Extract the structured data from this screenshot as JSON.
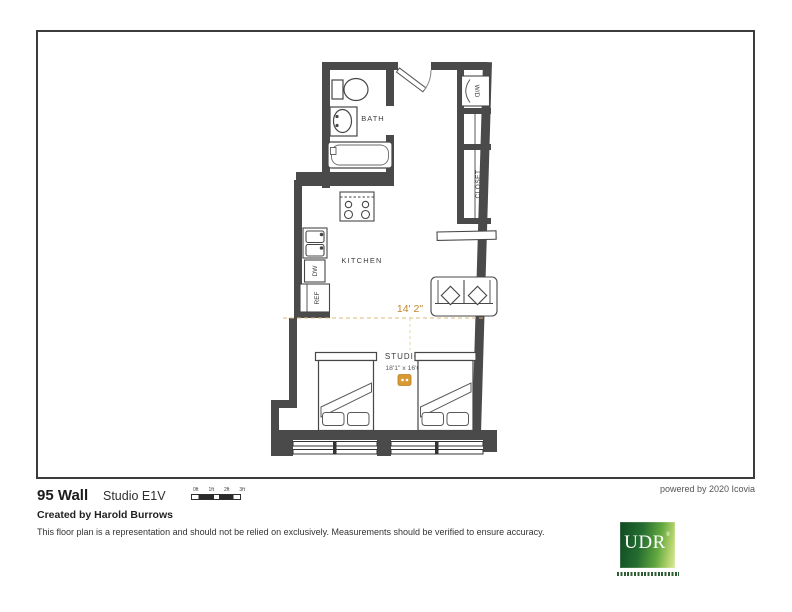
{
  "plan": {
    "labels": {
      "bath": "BATH",
      "kitchen": "KITCHEN",
      "studio": "STUDIO",
      "closet": "CLOSET",
      "washer_dryer": "W/D",
      "dishwasher": "DW",
      "refrigerator": "REF"
    },
    "dimensions": {
      "overall_width": "14' 2\"",
      "studio_room": "18'1\" x 16'0\""
    },
    "colors": {
      "wall": "#4a4a4a",
      "fixture_outline": "#474747",
      "dimension_text": "#c1862c",
      "dimension_line": "#dcb97e",
      "accent_icon": "#d99a33"
    }
  },
  "footer": {
    "property_name": "95 Wall",
    "unit_name": "Studio E1V",
    "scale_labels": [
      "0ft",
      "1ft",
      "2ft",
      "3ft"
    ],
    "created_by": "Created by Harold Burrows",
    "disclaimer": "This floor plan is a representation and should not be relied on exclusively. Measurements should be verified to ensure accuracy.",
    "powered_by": "powered by 2020 Icovia"
  },
  "logo": {
    "name": "UDR",
    "registered_mark": "®"
  }
}
